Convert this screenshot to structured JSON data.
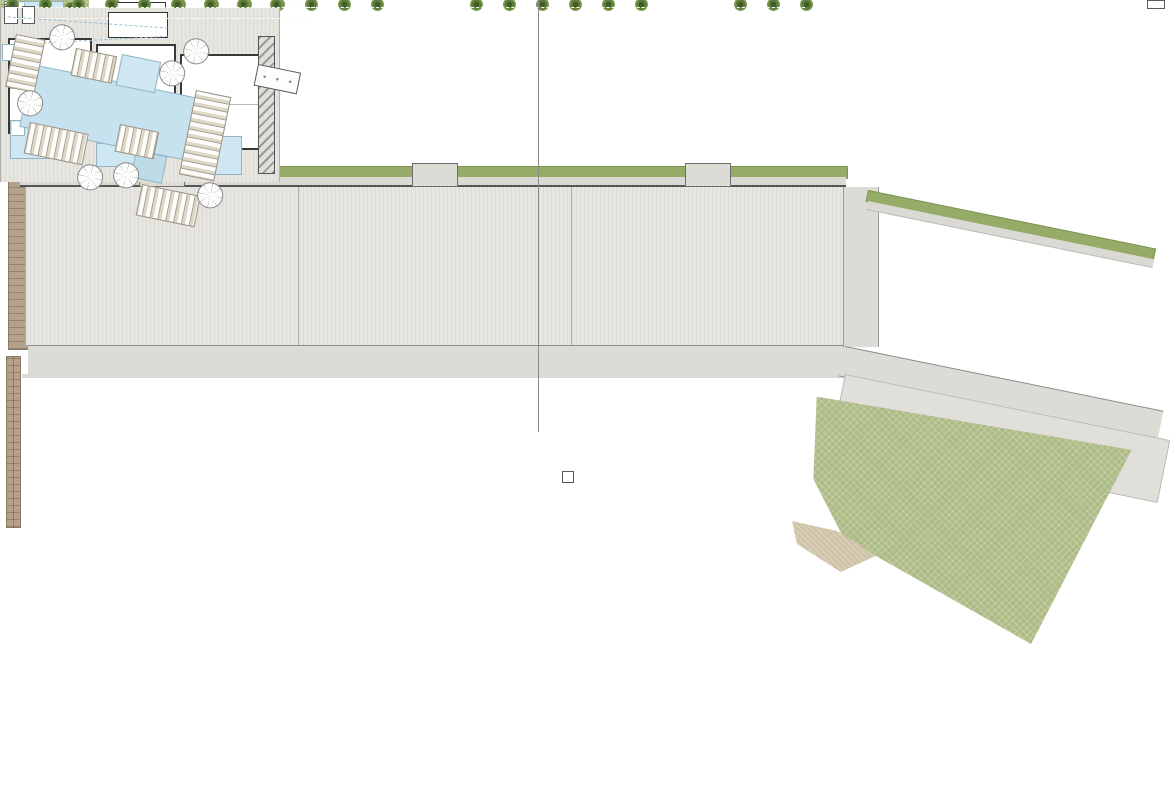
{
  "keyplan": {
    "blocks": [
      {
        "label": "B1"
      },
      {
        "label": "B2"
      },
      {
        "label": "B3"
      },
      {
        "label": "B4"
      }
    ],
    "villas": [
      {
        "label": "V1"
      },
      {
        "label": "V2"
      },
      {
        "label": "V3"
      },
      {
        "label": "V4"
      },
      {
        "label": "V5"
      },
      {
        "label": "V6"
      },
      {
        "label": "V7"
      },
      {
        "label": "V8"
      },
      {
        "label": "V9"
      }
    ],
    "internal_road_label": "VIAL INTERNO",
    "communal_pool_label": "PISCINA",
    "golf_course_label": "CAMPO DE GOLF",
    "north_label": "N"
  },
  "site": {
    "apartment_blocks": 3,
    "units_per_block": 3,
    "detached_block_units": 3,
    "villas": 9,
    "private_pools": 21,
    "communal_area": {
      "main_pool": true,
      "kids_pool": true,
      "jacuzzi": true,
      "parasols": 7,
      "lounger_decks": 6
    }
  },
  "colors": {
    "pool_blue": "#cfe7f3",
    "communal_pool_blue": "#c6e2ee",
    "lawn_green": "#adbb85",
    "hedge_green": "#96ab68",
    "tree_green": "#50702f",
    "terrace_grey": "#e6e5e0",
    "road_grey": "#dcdbd6",
    "stone_tan": "#b3a18b",
    "wall_dark": "#383838",
    "label_pink": "#a2487f"
  }
}
